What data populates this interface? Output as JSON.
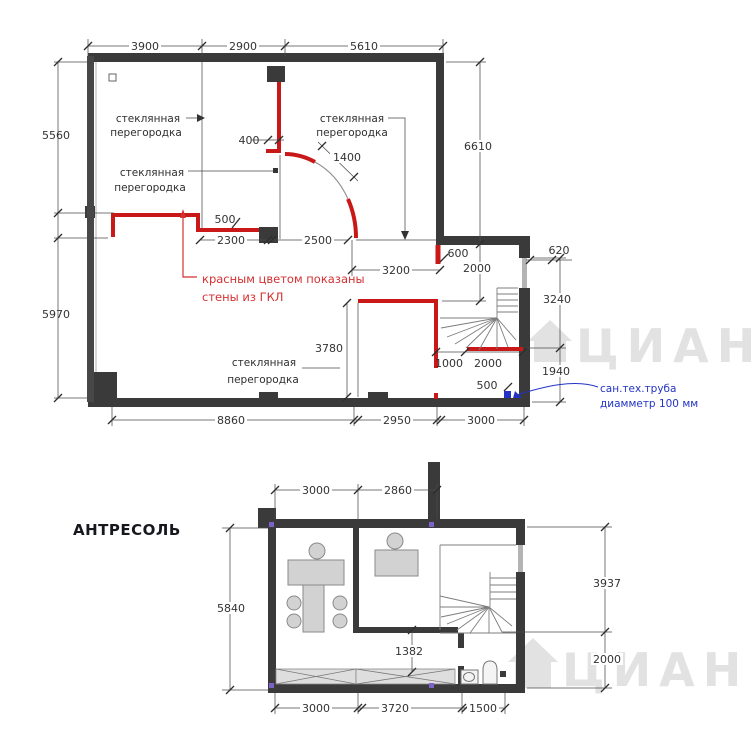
{
  "colors": {
    "wall": "#3a3a3a",
    "red_wall": "#c91818",
    "red_text": "#d43030",
    "blue": "#2334c4",
    "glass": "#8f8f8f",
    "marker_purple": "#7b61c8",
    "watermark": "#cbcbcb"
  },
  "floor1": {
    "dims_top": [
      "3900",
      "2900",
      "5610"
    ],
    "dims_left": [
      "5560",
      "5970"
    ],
    "dims_right": {
      "h6610": "6610",
      "w620": "620",
      "h3240": "3240",
      "h1940": "1940",
      "h2000": "2000"
    },
    "dims_inner": {
      "jog400": "400",
      "door1400": "1400",
      "step500": "500",
      "w2300": "2300",
      "w2500": "2500",
      "glass3200": "3200",
      "seg600": "600",
      "glass3780": "3780",
      "stair1000": "1000",
      "stair2000": "2000",
      "pipe500": "500"
    },
    "dims_bottom": [
      "8860",
      "2950",
      "3000"
    ],
    "glass_label": {
      "line1": "стеклянная",
      "line2": "перегородка"
    },
    "red_note": {
      "line1": "красным цветом  показаны",
      "line2": "стены из ГКЛ"
    },
    "pipe_note": {
      "line1": "сан.тех.труба",
      "line2": "диамметр 100 мм"
    }
  },
  "floor2": {
    "title": "АНТРЕСОЛЬ",
    "dims_top": [
      "3000",
      "2860"
    ],
    "dims_left": [
      "5840"
    ],
    "dims_right": [
      "3937",
      "2000"
    ],
    "dims_inner": [
      "1382"
    ],
    "dims_bottom": [
      "3000",
      "3720",
      "1500"
    ]
  },
  "watermark": {
    "text": "ЦИАН"
  }
}
